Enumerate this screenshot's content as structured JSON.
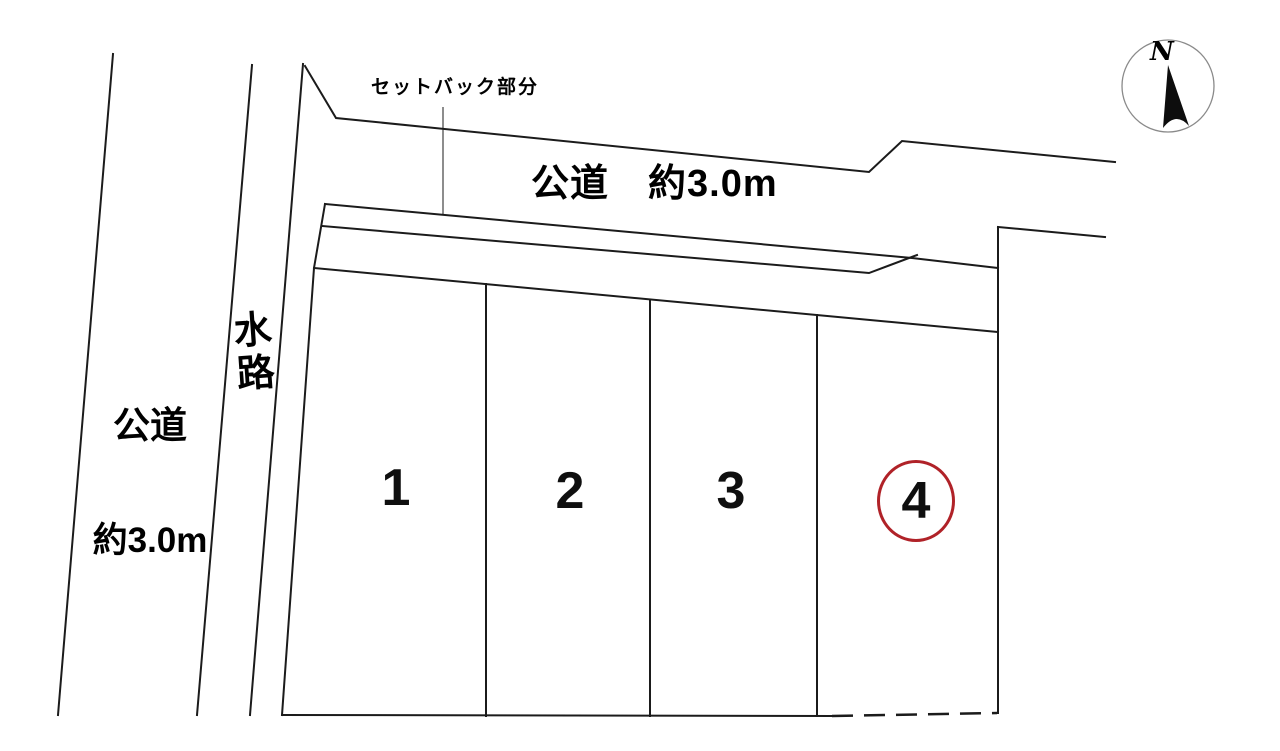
{
  "diagram": {
    "setback_label": "セットバック部分",
    "top_road_label": "公道　約3.0m",
    "left_road_label_line1": "公道",
    "left_road_label_line2": "約3.0m",
    "waterway_label": "水路",
    "compass_north": "N"
  },
  "plots": [
    {
      "number": "1",
      "highlighted": false
    },
    {
      "number": "2",
      "highlighted": false
    },
    {
      "number": "3",
      "highlighted": false
    },
    {
      "number": "4",
      "highlighted": true
    }
  ],
  "colors": {
    "line": "#1b1b1b",
    "highlight_circle": "#b02228",
    "compass_circle": "#8a8a8a",
    "background": "#ffffff"
  }
}
